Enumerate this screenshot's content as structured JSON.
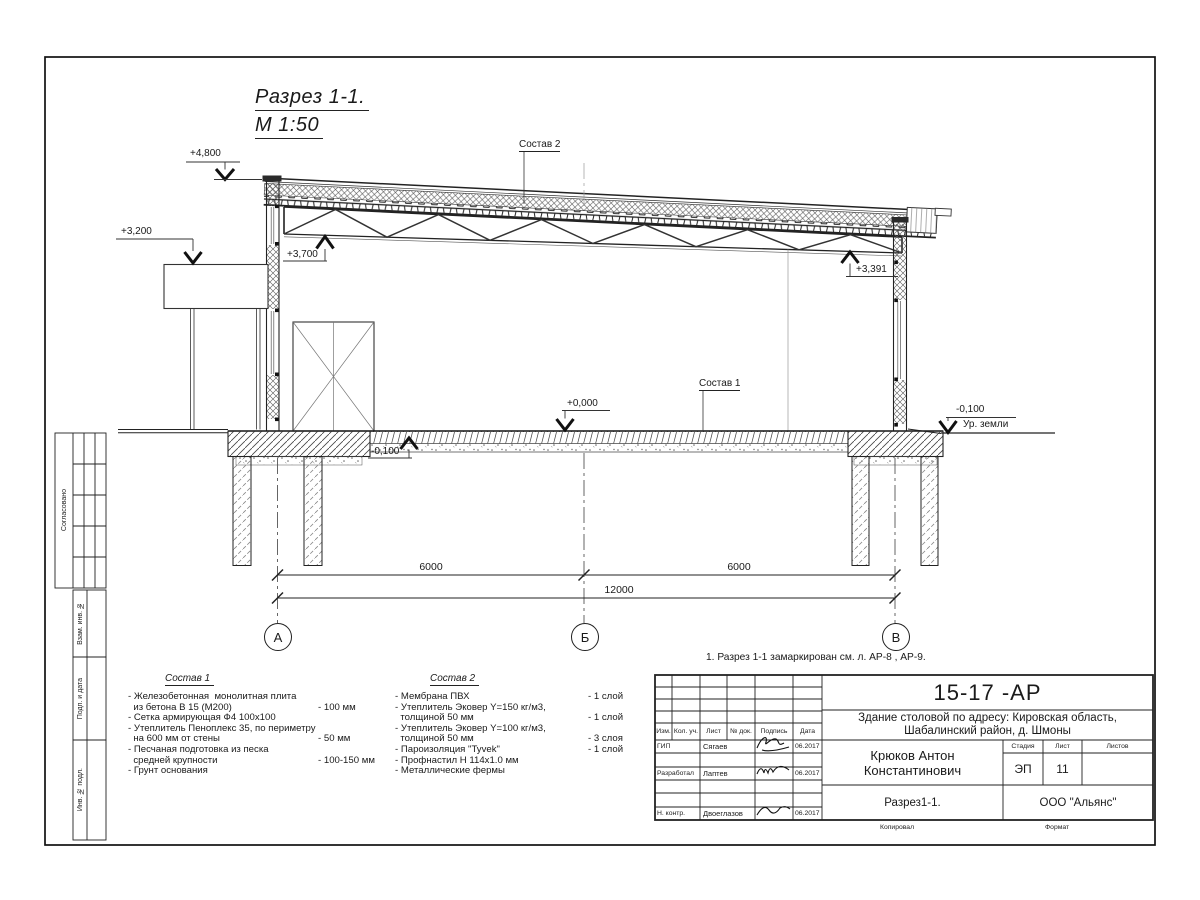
{
  "drawing": {
    "title": "Разрез 1-1.",
    "scale": "М 1:50",
    "note": "1. Разрез 1-1 замаркирован см. л. АР-8 , АР-9.",
    "ground_label": "Ур. земли",
    "callout1": "Состав 1",
    "callout2": "Состав 2",
    "elevations": {
      "e4800": "+4,800",
      "e3200": "+3,200",
      "e3700": "+3,700",
      "e3391": "+3,391",
      "e0000": "+0,000",
      "em100a": "-0,100",
      "em100b": "-0,100"
    },
    "dimensions": {
      "left": "6000",
      "right": "6000",
      "total": "12000"
    },
    "axis_labels": {
      "a": "А",
      "b": "Б",
      "v": "В"
    }
  },
  "sostav1": {
    "title": "Состав 1",
    "rows": [
      {
        "t": "- Железобетонная  монолитная плита",
        "v": ""
      },
      {
        "t": "  из бетона В 15 (М200)",
        "v": "- 100 мм"
      },
      {
        "t": "- Сетка армирующая Ф4 100х100",
        "v": ""
      },
      {
        "t": "- Утеплитель Пеноплекс 35, по периметру",
        "v": ""
      },
      {
        "t": "  на 600 мм от стены",
        "v": "- 50 мм"
      },
      {
        "t": "- Песчаная подготовка из песка",
        "v": ""
      },
      {
        "t": "  средней крупности",
        "v": "- 100-150 мм"
      },
      {
        "t": "- Грунт основания",
        "v": ""
      }
    ]
  },
  "sostav2": {
    "title": "Состав 2",
    "rows": [
      {
        "t": "- Мембрана ПВХ",
        "v": "- 1 слой"
      },
      {
        "t": "- Утеплитель Эковер Y=150 кг/м3,",
        "v": ""
      },
      {
        "t": "  толщиной 50 мм",
        "v": "- 1 слой"
      },
      {
        "t": "- Утеплитель Эковер Y=100 кг/м3,",
        "v": ""
      },
      {
        "t": "  толщиной 50 мм",
        "v": "- 3 слоя"
      },
      {
        "t": "- Пароизоляция \"Tyvek\"",
        "v": "- 1 слой"
      },
      {
        "t": "- Профнастил Н 114х1.0 мм",
        "v": ""
      },
      {
        "t": "- Металлические фермы",
        "v": ""
      }
    ]
  },
  "stamp": {
    "code": "15-17 -АР",
    "project1": "Здание столовой по адресу: Кировская область,",
    "project2": "Шабалинский район, д. Шмоны",
    "author": "Крюков Антон Константинович",
    "doc_title": "Разрез1-1.",
    "company": "ООО \"Альянс\"",
    "stage_label": "Стадия",
    "sheet_label": "Лист",
    "sheets_label": "Листов",
    "stage": "ЭП",
    "sheet": "11",
    "sheets": "",
    "copied": "Копировал",
    "format": "Формат",
    "cols": {
      "izm": "Изм.",
      "kol": "Кол. уч.",
      "list": "Лист",
      "ndok": "№ док.",
      "podpis": "Подпись",
      "data": "Дата"
    },
    "rows": [
      {
        "role": "ГИП",
        "name": "Сягаев",
        "date": "06.2017"
      },
      {
        "role": "Разработал",
        "name": "Лаптев",
        "date": "06.2017"
      },
      {
        "role": "Н. контр.",
        "name": "Двоеглазов",
        "date": "06.2017"
      }
    ]
  },
  "sidebar": {
    "soglasovano": "Согласовано",
    "vzam": "Взам. инв. №",
    "podp": "Подп. и дата",
    "inv": "Инв. № подл."
  }
}
